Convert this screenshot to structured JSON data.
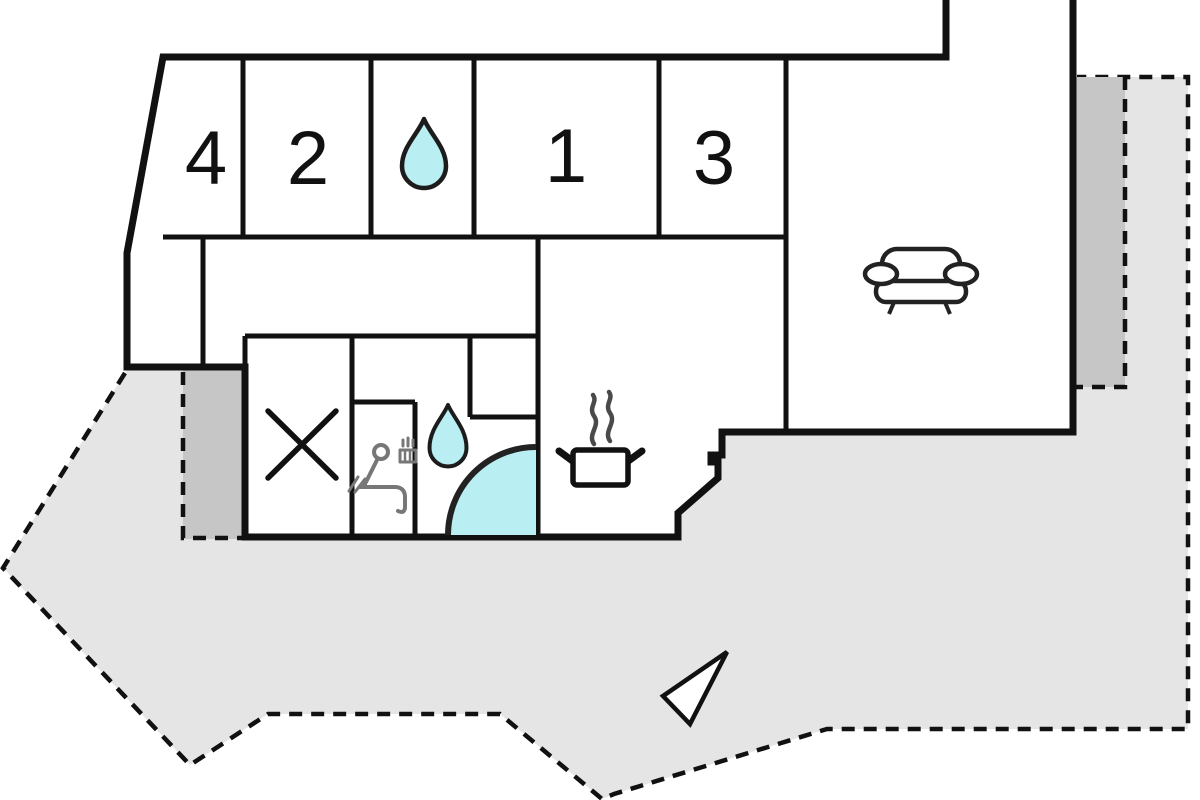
{
  "page": {
    "title": "vacation-home-floor-plan"
  },
  "rooms": {
    "bedroom4": {
      "label": "4"
    },
    "bedroom2": {
      "label": "2"
    },
    "bedroom1": {
      "label": "1"
    },
    "bedroom3": {
      "label": "3"
    }
  },
  "icons": {
    "bathroom_top": "water-drop-icon",
    "bathroom_lower": "water-drop-icon",
    "shower": "corner-shower-quarter-circle-icon",
    "sauna": "sauna-person-icon",
    "kitchen": "steaming-pot-icon",
    "living_room": "sofa-icon",
    "utility_room": "x-marker-icon",
    "compass": "north-arrow-icon"
  },
  "colors": {
    "terrace_light": "#e5e5e5",
    "terrace_dark": "#c6c6c6",
    "water": "#b9eef2",
    "wall": "#111111",
    "background": "#ffffff"
  }
}
